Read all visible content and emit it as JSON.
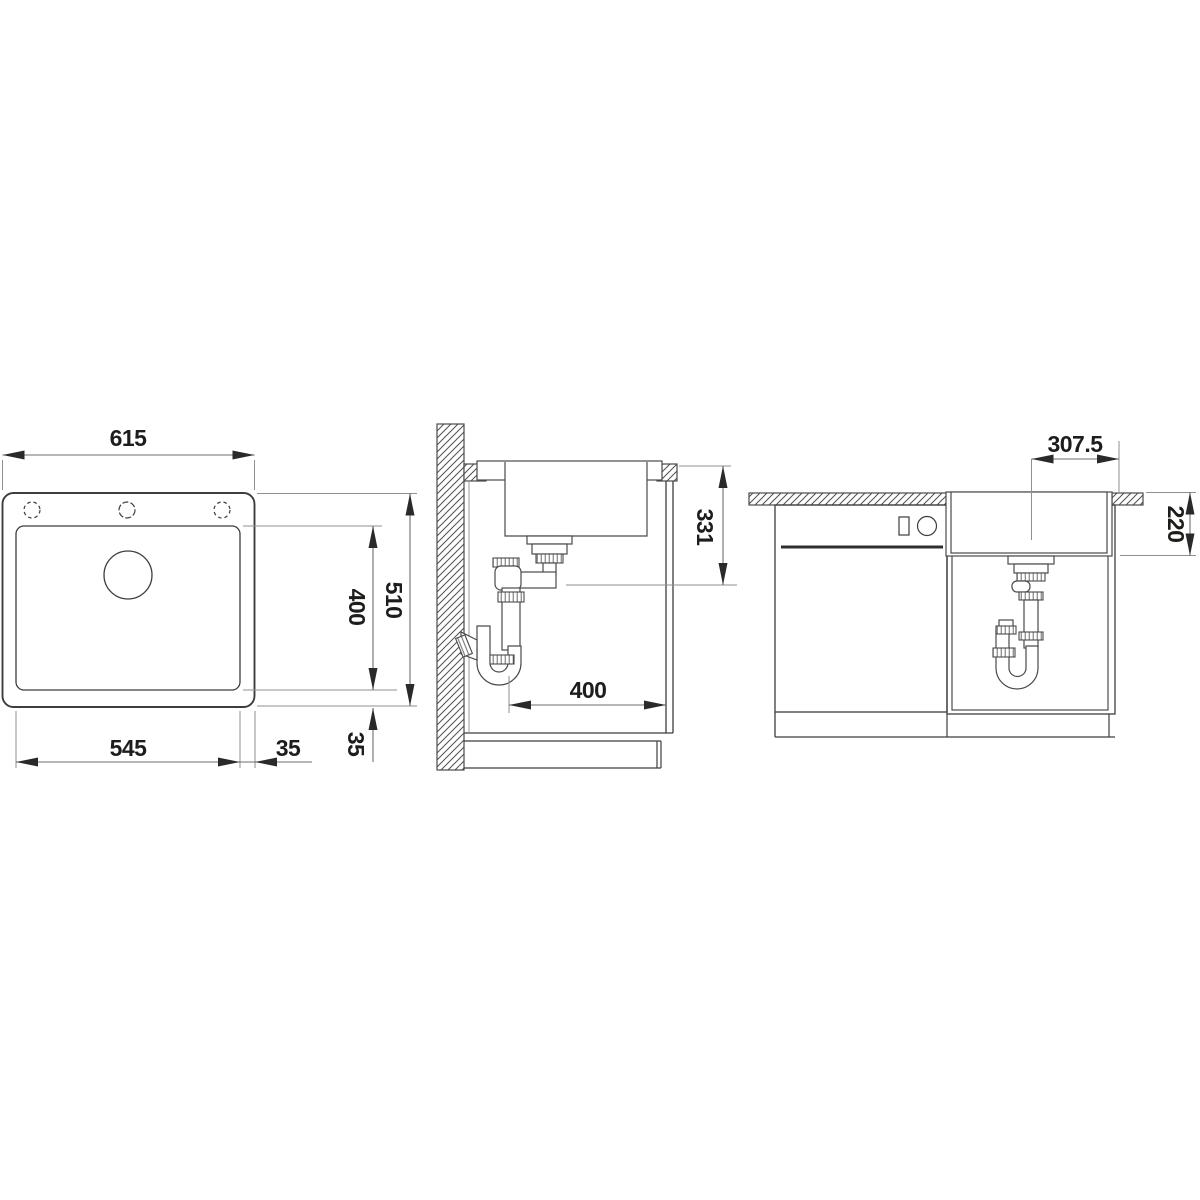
{
  "drawing_title": "sink-installation-technical-drawing",
  "colors": {
    "background": "#ffffff",
    "main_line": "#3d3d3d",
    "extension_line": "#8f8f8f",
    "text": "#1d1d1b"
  },
  "views": {
    "top": {
      "dim_overall_width": "615",
      "dim_cutout_width": "545",
      "dim_offset_right": "35",
      "dim_overall_depth": "510",
      "dim_cutout_depth": "400",
      "dim_offset_bottom": "35"
    },
    "section": {
      "dim_drain_height": "331",
      "dim_clearance_depth": "400"
    },
    "front": {
      "dim_drain_center_offset": "307.5",
      "dim_bowl_depth": "220"
    }
  }
}
